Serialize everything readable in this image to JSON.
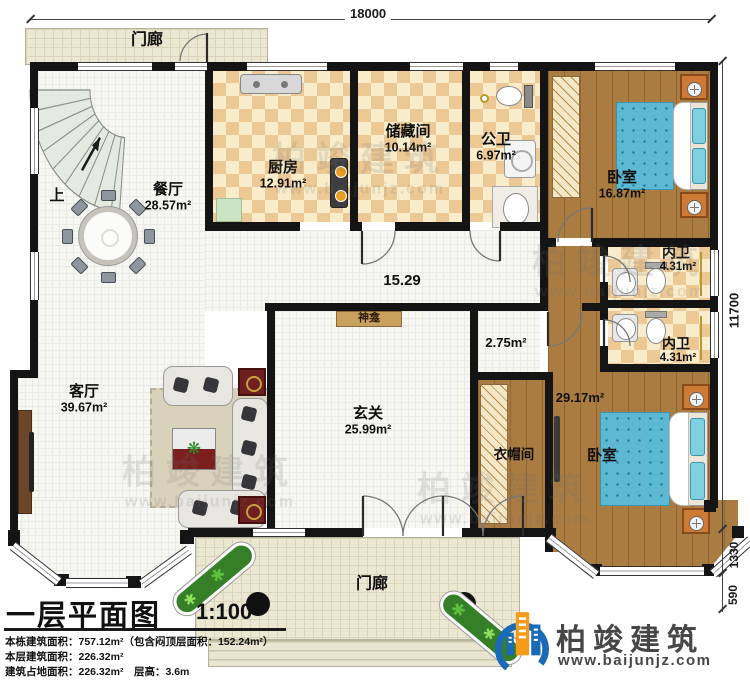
{
  "dims": {
    "top": "18000",
    "right_main": "11700",
    "right_bay": "1330",
    "right_porch": "590"
  },
  "rooms": {
    "porch_top": {
      "name": "门廊"
    },
    "porch_bottom": {
      "name": "门廊"
    },
    "stairs": {
      "up": "上"
    },
    "dining": {
      "name": "餐厅",
      "area": "28.57m²"
    },
    "kitchen": {
      "name": "厨房",
      "area": "12.91m²"
    },
    "storage": {
      "name": "储藏间",
      "area": "10.14m²"
    },
    "public_bath": {
      "name": "公卫",
      "area": "6.97m²"
    },
    "bedroom_top": {
      "name": "卧室",
      "area": "16.87m²"
    },
    "hall": {
      "area": "15.29"
    },
    "corridor": {
      "area": "2.75m²"
    },
    "shrine": {
      "name": "神龛"
    },
    "bath_en1": {
      "name": "内卫",
      "area": "4.31m²"
    },
    "bath_en2": {
      "name": "内卫",
      "area": "4.31m²"
    },
    "living": {
      "name": "客厅",
      "area": "39.67m²"
    },
    "foyer": {
      "name": "玄关",
      "area": "25.99m²"
    },
    "cloakroom": {
      "name": "衣帽间"
    },
    "bedroom_bottom": {
      "name": "卧室",
      "area": "29.17m²"
    }
  },
  "title_block": {
    "title": "一层平面图",
    "scale": "1:100",
    "line1": "本栋建筑面积：757.12m²（包含闷顶层面积：152.24m²）",
    "line2": "本层建筑面积：226.32m²",
    "line3": "建筑占地面积：226.32m²　层高：3.6m"
  },
  "logo": {
    "brand": "柏竣建筑",
    "url": "www.baijunjz.com"
  },
  "watermark": {
    "brand": "柏竣建筑",
    "url": "www.baijunjz.com"
  },
  "colors": {
    "wall": "#141414",
    "wood": "#aa7c42",
    "checker_dark": "#ecc894",
    "checker_light": "#f8ecca",
    "porch": "#ebe7d2",
    "bed_blue": "#5cb8d3",
    "logo_blue": "#1a6ab8",
    "logo_orange": "#f59b1c"
  }
}
